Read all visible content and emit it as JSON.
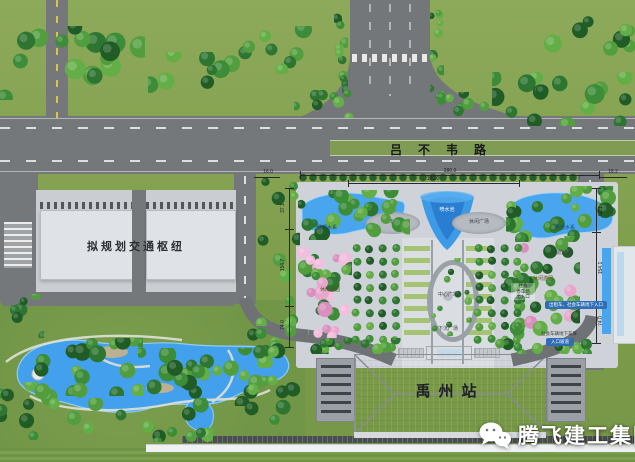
{
  "roads": {
    "main_road_name": "吕不韦路"
  },
  "areas": {
    "hub_label": "拟规划交通枢纽",
    "station_label": "禹州站",
    "pond_left_label": "景观水系",
    "pond_right_label": "景观水系",
    "fountain_label": "喷水池",
    "square_left_label": "树阵广场",
    "square_right_label": "休闲广场",
    "center_plaza_label": "中心广场",
    "sunken_plaza_label": "下沉广场",
    "fire_lane_label": "消防通道",
    "grove_left_label": "休闲游园",
    "grove_right_label": "休闲游园",
    "parking_exit_lines": [
      "社会",
      "停车场",
      "出入口"
    ],
    "taxi_entry_label": "出租车、社会车辆地下入口",
    "garage_text": "社会车辆地下车库",
    "garage_ramp_label": "入口坡道"
  },
  "dimensions": {
    "top_total": "280.0",
    "top_inner": "190.0",
    "top_left": "16.0",
    "top_right": "18.2",
    "left": [
      "37.1",
      "154.7",
      "74.0"
    ],
    "right": [
      "52.1",
      "154.1",
      "74.0"
    ]
  },
  "watermark": {
    "text": "腾飞建工集团",
    "icon": "wechat-icon"
  },
  "colors": {
    "water": "#45a0ea",
    "road": "#75787b",
    "plaza": "#cfd3d9",
    "grass": "#84a251",
    "label_blue": "#2f6db5"
  }
}
